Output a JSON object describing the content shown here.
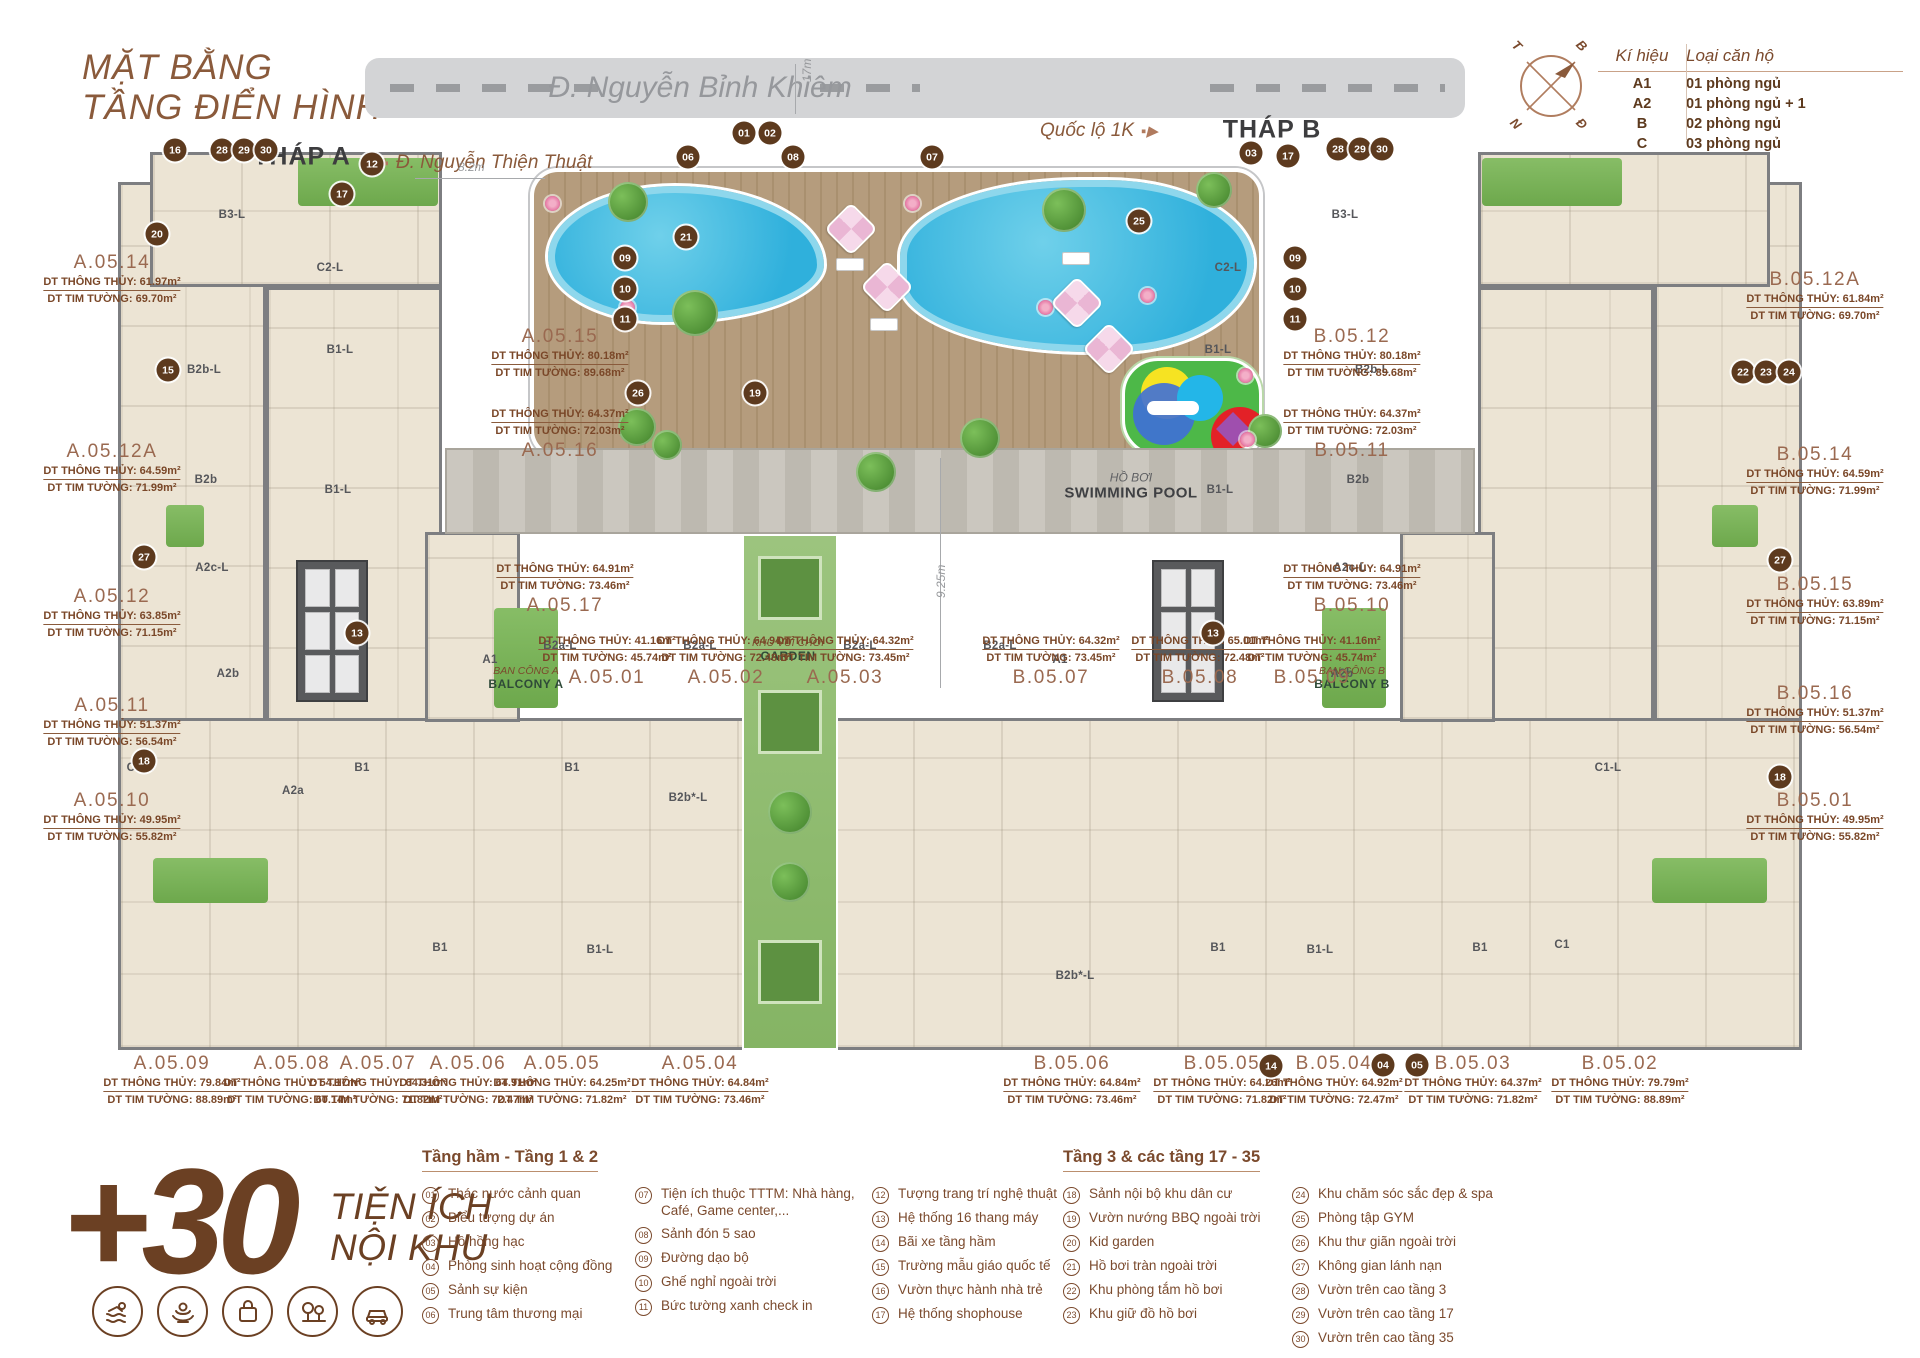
{
  "header": {
    "title1": "MẶT BẰNG",
    "title2": "TẦNG ĐIỂN HÌNH",
    "tower_a": "THÁP A",
    "tower_b": "THÁP B"
  },
  "roads": {
    "main": "Đ. Nguyễn Bỉnh Khiêm",
    "main_width": "17m",
    "left_street": "Đ. Nguyễn Thiện Thuật",
    "right_street": "Quốc lộ 1K"
  },
  "compass": {
    "nw": "T",
    "ne": "B",
    "sw": "N",
    "se": "Đ"
  },
  "legend_table": {
    "col_symbol": "Kí hiệu",
    "col_type": "Loại căn hộ",
    "rows": [
      {
        "symbol": "A1",
        "type": "01 phòng ngủ"
      },
      {
        "symbol": "A2",
        "type": "01 phòng ngủ + 1"
      },
      {
        "symbol": "B",
        "type": "02 phòng ngủ"
      },
      {
        "symbol": "C",
        "type": "03 phòng ngủ"
      }
    ]
  },
  "plan": {
    "pool_label": {
      "vi": "HỒ BƠI",
      "en": "SWIMMING POOL"
    },
    "garden_label": {
      "vi": "KHU VUI CHƠI",
      "en": "GARDEN"
    },
    "balcony_a": {
      "vi": "BAN CÔNG A",
      "en": "BALCONY A"
    },
    "balcony_b": {
      "vi": "BAN CÔNG B",
      "en": "BALCONY B"
    },
    "dim_deck": "8.2m",
    "dim_court": "9.25m",
    "units": [
      {
        "id": "A.05.14",
        "tt": "DT THÔNG THỦY: 61.97m²",
        "tw": "DT TIM TƯỜNG: 69.70m²",
        "x": 112,
        "y": 252
      },
      {
        "id": "A.05.12A",
        "tt": "DT THÔNG THỦY: 64.59m²",
        "tw": "DT TIM TƯỜNG: 71.99m²",
        "x": 112,
        "y": 441
      },
      {
        "id": "A.05.12",
        "tt": "DT THÔNG THỦY: 63.85m²",
        "tw": "DT TIM TƯỜNG: 71.15m²",
        "x": 112,
        "y": 586
      },
      {
        "id": "A.05.11",
        "tt": "DT THÔNG THỦY: 51.37m²",
        "tw": "DT TIM TƯỜNG: 56.54m²",
        "x": 112,
        "y": 695
      },
      {
        "id": "A.05.10",
        "tt": "DT THÔNG THỦY: 49.95m²",
        "tw": "DT TIM TƯỜNG: 55.82m²",
        "x": 112,
        "y": 790
      },
      {
        "id": "A.05.15",
        "tt": "DT THÔNG THỦY: 80.18m²",
        "tw": "DT TIM TƯỜNG: 89.68m²",
        "x": 560,
        "y": 326
      },
      {
        "id": "A.05.16",
        "tt": "DT THÔNG THỦY: 64.37m²",
        "tw": "DT TIM TƯỜNG: 72.03m²",
        "x": 560,
        "y": 408,
        "cls": "name-last"
      },
      {
        "id": "A.05.17",
        "tt": "DT THÔNG THỦY: 64.91m²",
        "tw": "DT TIM TƯỜNG: 73.46m²",
        "x": 565,
        "y": 563,
        "cls": "name-last"
      },
      {
        "id": "B.05.12",
        "tt": "DT THÔNG THỦY: 80.18m²",
        "tw": "DT TIM TƯỜNG: 89.68m²",
        "x": 1352,
        "y": 326
      },
      {
        "id": "B.05.11",
        "tt": "DT THÔNG THỦY: 64.37m²",
        "tw": "DT TIM TƯỜNG: 72.03m²",
        "x": 1352,
        "y": 408,
        "cls": "name-last"
      },
      {
        "id": "B.05.10",
        "tt": "DT THÔNG THỦY: 64.91m²",
        "tw": "DT TIM TƯỜNG: 73.46m²",
        "x": 1352,
        "y": 563,
        "cls": "name-last"
      },
      {
        "id": "A.05.01",
        "tt": "DT THÔNG THỦY: 41.16m²",
        "tw": "DT TIM TƯỜNG: 45.74m²",
        "x": 607,
        "y": 635,
        "cls": "name-last"
      },
      {
        "id": "A.05.02",
        "tt": "DT THÔNG THỦY: 64.94m²",
        "tw": "DT TIM TƯỜNG: 72.48m²",
        "x": 726,
        "y": 635,
        "cls": "name-last"
      },
      {
        "id": "A.05.03",
        "tt": "DT THÔNG THỦY: 64.32m²",
        "tw": "DT TIM TƯỜNG: 73.45m²",
        "x": 845,
        "y": 635,
        "cls": "name-last"
      },
      {
        "id": "B.05.07",
        "tt": "DT THÔNG THỦY: 64.32m²",
        "tw": "DT TIM TƯỜNG: 73.45m²",
        "x": 1051,
        "y": 635,
        "cls": "name-last"
      },
      {
        "id": "B.05.08",
        "tt": "DT THÔNG THỦY: 65.01m²",
        "tw": "DT TIM TƯỜNG: 72.48m²",
        "x": 1200,
        "y": 635,
        "cls": "name-last"
      },
      {
        "id": "B.05.09",
        "tt": "DT THÔNG THỦY: 41.16m²",
        "tw": "DT TIM TƯỜNG: 45.74m²",
        "x": 1312,
        "y": 635,
        "cls": "name-last"
      },
      {
        "id": "B.05.12A",
        "tt": "DT THÔNG THỦY: 61.84m²",
        "tw": "DT TIM TƯỜNG: 69.70m²",
        "x": 1815,
        "y": 269
      },
      {
        "id": "B.05.14",
        "tt": "DT THÔNG THỦY: 64.59m²",
        "tw": "DT TIM TƯỜNG: 71.99m²",
        "x": 1815,
        "y": 444
      },
      {
        "id": "B.05.15",
        "tt": "DT THÔNG THỦY: 63.89m²",
        "tw": "DT TIM TƯỜNG: 71.15m²",
        "x": 1815,
        "y": 574
      },
      {
        "id": "B.05.16",
        "tt": "DT THÔNG THỦY: 51.37m²",
        "tw": "DT TIM TƯỜNG: 56.54m²",
        "x": 1815,
        "y": 683
      },
      {
        "id": "B.05.01",
        "tt": "DT THÔNG THỦY: 49.95m²",
        "tw": "DT TIM TƯỜNG: 55.82m²",
        "x": 1815,
        "y": 790
      },
      {
        "id": "A.05.09",
        "tt": "DT THÔNG THỦY: 79.84m²",
        "tw": "DT TIM TƯỜNG: 88.89m²",
        "x": 172,
        "y": 1053
      },
      {
        "id": "A.05.08",
        "tt": "DT THÔNG THỦY: 54.17m²",
        "tw": "DT TIM TƯỜNG: 60.14m²",
        "x": 292,
        "y": 1053
      },
      {
        "id": "A.05.07",
        "tt": "DT THÔNG THỦY: 64.31m²",
        "tw": "DT TIM TƯỜNG: 71.82m²",
        "x": 378,
        "y": 1053
      },
      {
        "id": "A.05.06",
        "tt": "DT THÔNG THỦY: 64.91m²",
        "tw": "DT TIM TƯỜNG: 72.47m²",
        "x": 468,
        "y": 1053
      },
      {
        "id": "A.05.05",
        "tt": "DT THÔNG THỦY: 64.25m²",
        "tw": "DT TIM TƯỜNG: 71.82m²",
        "x": 562,
        "y": 1053
      },
      {
        "id": "A.05.04",
        "tt": "DT THÔNG THỦY: 64.84m²",
        "tw": "DT TIM TƯỜNG: 73.46m²",
        "x": 700,
        "y": 1053
      },
      {
        "id": "B.05.06",
        "tt": "DT THÔNG THỦY: 64.84m²",
        "tw": "DT TIM TƯỜNG: 73.46m²",
        "x": 1072,
        "y": 1053
      },
      {
        "id": "B.05.05",
        "tt": "DT THÔNG THỦY: 64.26m²",
        "tw": "DT TIM TƯỜNG: 71.82m²",
        "x": 1222,
        "y": 1053
      },
      {
        "id": "B.05.04",
        "tt": "DT THÔNG THỦY: 64.92m²",
        "tw": "DT TIM TƯỜNG: 72.47m²",
        "x": 1334,
        "y": 1053
      },
      {
        "id": "B.05.03",
        "tt": "DT THÔNG THỦY: 64.37m²",
        "tw": "DT TIM TƯỜNG: 71.82m²",
        "x": 1473,
        "y": 1053
      },
      {
        "id": "B.05.02",
        "tt": "DT THÔNG THỦY: 79.79m²",
        "tw": "DT TIM TƯỜNG: 88.89m²",
        "x": 1620,
        "y": 1053
      }
    ],
    "unit_types": [
      {
        "t": "B3-L",
        "x": 232,
        "y": 215
      },
      {
        "t": "C2-L",
        "x": 330,
        "y": 268
      },
      {
        "t": "B2b-L",
        "x": 204,
        "y": 370
      },
      {
        "t": "B1-L",
        "x": 340,
        "y": 350
      },
      {
        "t": "B2b",
        "x": 206,
        "y": 480
      },
      {
        "t": "B1-L",
        "x": 338,
        "y": 490
      },
      {
        "t": "A2c-L",
        "x": 212,
        "y": 568
      },
      {
        "t": "A2b",
        "x": 228,
        "y": 674
      },
      {
        "t": "A1",
        "x": 490,
        "y": 660
      },
      {
        "t": "B2a-L",
        "x": 560,
        "y": 646
      },
      {
        "t": "B2a-L",
        "x": 700,
        "y": 646
      },
      {
        "t": "C1-L",
        "x": 140,
        "y": 768
      },
      {
        "t": "A2a",
        "x": 293,
        "y": 791
      },
      {
        "t": "B1",
        "x": 362,
        "y": 768
      },
      {
        "t": "B1",
        "x": 572,
        "y": 768
      },
      {
        "t": "B2b*-L",
        "x": 688,
        "y": 798
      },
      {
        "t": "B1",
        "x": 440,
        "y": 948
      },
      {
        "t": "B1-L",
        "x": 600,
        "y": 950
      },
      {
        "t": "B3-L",
        "x": 1345,
        "y": 215
      },
      {
        "t": "C2-L",
        "x": 1228,
        "y": 268
      },
      {
        "t": "B2b-L",
        "x": 1372,
        "y": 370
      },
      {
        "t": "B1-L",
        "x": 1218,
        "y": 350
      },
      {
        "t": "B2b",
        "x": 1358,
        "y": 480
      },
      {
        "t": "B1-L",
        "x": 1220,
        "y": 490
      },
      {
        "t": "A2c-L",
        "x": 1350,
        "y": 568
      },
      {
        "t": "A2b",
        "x": 1342,
        "y": 674
      },
      {
        "t": "A1",
        "x": 1060,
        "y": 660
      },
      {
        "t": "B2a-L",
        "x": 1000,
        "y": 646
      },
      {
        "t": "B2a-L",
        "x": 860,
        "y": 646
      },
      {
        "t": "B2b*-L",
        "x": 1075,
        "y": 976
      },
      {
        "t": "B1",
        "x": 1218,
        "y": 948
      },
      {
        "t": "B1-L",
        "x": 1320,
        "y": 950
      },
      {
        "t": "B1",
        "x": 1480,
        "y": 948
      },
      {
        "t": "C1",
        "x": 1562,
        "y": 945
      },
      {
        "t": "C1-L",
        "x": 1608,
        "y": 768
      }
    ],
    "badges": [
      {
        "n": "16",
        "x": 175,
        "y": 150
      },
      {
        "n": "28",
        "x": 222,
        "y": 150
      },
      {
        "n": "29",
        "x": 244,
        "y": 150
      },
      {
        "n": "30",
        "x": 266,
        "y": 150
      },
      {
        "n": "20",
        "x": 157,
        "y": 234
      },
      {
        "n": "12",
        "x": 372,
        "y": 164
      },
      {
        "n": "17",
        "x": 342,
        "y": 194
      },
      {
        "n": "15",
        "x": 168,
        "y": 370
      },
      {
        "n": "27",
        "x": 144,
        "y": 557
      },
      {
        "n": "18",
        "x": 144,
        "y": 761
      },
      {
        "n": "13",
        "x": 357,
        "y": 633
      },
      {
        "n": "01",
        "x": 744,
        "y": 133
      },
      {
        "n": "02",
        "x": 770,
        "y": 133
      },
      {
        "n": "06",
        "x": 688,
        "y": 157
      },
      {
        "n": "08",
        "x": 793,
        "y": 157
      },
      {
        "n": "07",
        "x": 932,
        "y": 157
      },
      {
        "n": "09",
        "x": 625,
        "y": 258
      },
      {
        "n": "10",
        "x": 625,
        "y": 289
      },
      {
        "n": "11",
        "x": 625,
        "y": 319
      },
      {
        "n": "09",
        "x": 1295,
        "y": 258
      },
      {
        "n": "10",
        "x": 1295,
        "y": 289
      },
      {
        "n": "11",
        "x": 1295,
        "y": 319
      },
      {
        "n": "21",
        "x": 686,
        "y": 237
      },
      {
        "n": "26",
        "x": 638,
        "y": 393
      },
      {
        "n": "19",
        "x": 755,
        "y": 393
      },
      {
        "n": "25",
        "x": 1139,
        "y": 221
      },
      {
        "n": "03",
        "x": 1251,
        "y": 153
      },
      {
        "n": "17",
        "x": 1288,
        "y": 156
      },
      {
        "n": "28",
        "x": 1338,
        "y": 149
      },
      {
        "n": "29",
        "x": 1360,
        "y": 149
      },
      {
        "n": "30",
        "x": 1382,
        "y": 149
      },
      {
        "n": "22",
        "x": 1743,
        "y": 372
      },
      {
        "n": "23",
        "x": 1766,
        "y": 372
      },
      {
        "n": "24",
        "x": 1789,
        "y": 372
      },
      {
        "n": "27",
        "x": 1780,
        "y": 560
      },
      {
        "n": "18",
        "x": 1780,
        "y": 777
      },
      {
        "n": "13",
        "x": 1213,
        "y": 633
      },
      {
        "n": "14",
        "x": 1271,
        "y": 1066
      },
      {
        "n": "04",
        "x": 1383,
        "y": 1065
      },
      {
        "n": "05",
        "x": 1417,
        "y": 1065
      }
    ]
  },
  "amenities": {
    "logo_plus": "+30",
    "logo_line1": "TIỆN ÍCH",
    "logo_line2": "NỘI KHU",
    "icons": [
      "pool-icon",
      "spa-icon",
      "shopping-icon",
      "trees-icon",
      "parking-icon"
    ],
    "group1_title": "Tầng hầm - Tầng 1 & 2",
    "group2_title": "Tầng 3 & các tầng 17 - 35",
    "col1": [
      {
        "n": "01",
        "t": "Thác nước cảnh quan"
      },
      {
        "n": "02",
        "t": "Biểu tượng dự án"
      },
      {
        "n": "03",
        "t": "Hồ hồng hạc"
      },
      {
        "n": "04",
        "t": "Phòng sinh hoạt cộng đồng"
      },
      {
        "n": "05",
        "t": "Sảnh sự kiện"
      },
      {
        "n": "06",
        "t": "Trung tâm thương mại"
      }
    ],
    "col2": [
      {
        "n": "07",
        "t": "Tiện ích thuộc TTTM: Nhà hàng, Café, Game center,..."
      },
      {
        "n": "08",
        "t": "Sảnh đón 5 sao"
      },
      {
        "n": "09",
        "t": "Đường dạo bộ"
      },
      {
        "n": "10",
        "t": "Ghế nghỉ ngoài trời"
      },
      {
        "n": "11",
        "t": "Bức tường xanh check in"
      }
    ],
    "col3": [
      {
        "n": "12",
        "t": "Tượng trang trí nghệ thuật"
      },
      {
        "n": "13",
        "t": "Hệ thống 16 thang máy"
      },
      {
        "n": "14",
        "t": "Bãi xe tầng hầm"
      },
      {
        "n": "15",
        "t": "Trường mẫu giáo quốc tế"
      },
      {
        "n": "16",
        "t": "Vườn thực hành nhà trẻ"
      },
      {
        "n": "17",
        "t": "Hệ thống shophouse"
      }
    ],
    "col4": [
      {
        "n": "18",
        "t": "Sảnh nội bộ khu dân cư"
      },
      {
        "n": "19",
        "t": "Vườn nướng BBQ ngoài trời"
      },
      {
        "n": "20",
        "t": "Kid garden"
      },
      {
        "n": "21",
        "t": "Hồ bơi tràn ngoài trời"
      },
      {
        "n": "22",
        "t": "Khu phòng tắm hồ bơi"
      },
      {
        "n": "23",
        "t": "Khu giữ đồ hồ bơi"
      }
    ],
    "col5": [
      {
        "n": "24",
        "t": "Khu chăm sóc sắc đẹp & spa"
      },
      {
        "n": "25",
        "t": "Phòng tập GYM"
      },
      {
        "n": "26",
        "t": "Khu thư giãn ngoài trời"
      },
      {
        "n": "27",
        "t": "Không gian lánh nạn"
      },
      {
        "n": "28",
        "t": "Vườn trên cao tầng 3"
      },
      {
        "n": "29",
        "t": "Vườn trên cao tầng 17"
      },
      {
        "n": "30",
        "t": "Vườn trên cao tầng 35"
      }
    ]
  }
}
